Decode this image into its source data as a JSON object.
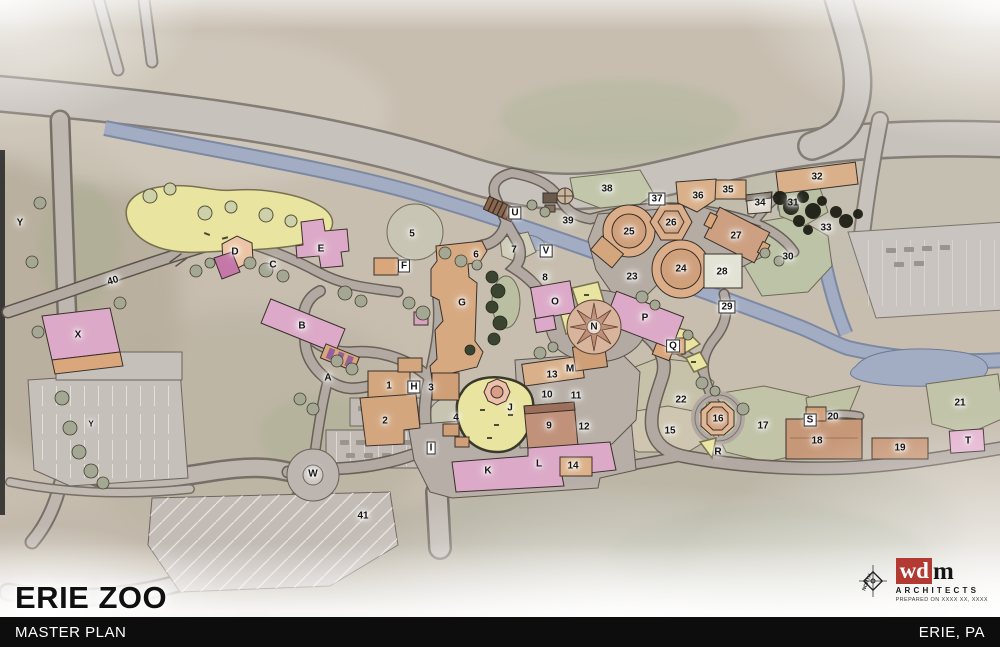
{
  "title": {
    "zoo": "ERIE ZOO"
  },
  "footer": {
    "project": "MASTER PLAN",
    "location": "ERIE, PA"
  },
  "logo": {
    "compass_label": "NORTH",
    "brand_wd": "wd",
    "brand_m": "m",
    "firm": "ARCHITECTS",
    "prepared_note": "PREPARED ON XXXX XX, XXXX"
  },
  "palette": {
    "footer_bg": "#0d0d0d",
    "footer_text": "#ffffff",
    "title_text": "#101010",
    "logo_red": "#b23a32",
    "map_base": "#c7beb0",
    "river_blue": "#a2adc4",
    "lawn_yellow": "#e9e4a0",
    "building_pink": "#dcaac8",
    "building_tan": "#d9ad85",
    "exhibit_green": "#bcc1a4",
    "road_gray": "#c6c0ba"
  },
  "map": {
    "markers": [
      {
        "id": "A",
        "x": 328,
        "y": 378
      },
      {
        "id": "B",
        "x": 302,
        "y": 326
      },
      {
        "id": "C",
        "x": 273,
        "y": 265
      },
      {
        "id": "D",
        "x": 235,
        "y": 252
      },
      {
        "id": "E",
        "x": 321,
        "y": 249
      },
      {
        "id": "F",
        "x": 404,
        "y": 266,
        "style": "box"
      },
      {
        "id": "G",
        "x": 462,
        "y": 303
      },
      {
        "id": "H",
        "x": 414,
        "y": 387,
        "style": "box"
      },
      {
        "id": "I",
        "x": 431,
        "y": 448,
        "style": "box"
      },
      {
        "id": "J",
        "x": 510,
        "y": 408
      },
      {
        "id": "K",
        "x": 488,
        "y": 471
      },
      {
        "id": "L",
        "x": 539,
        "y": 464
      },
      {
        "id": "M",
        "x": 570,
        "y": 369
      },
      {
        "id": "N",
        "x": 594,
        "y": 327
      },
      {
        "id": "O",
        "x": 555,
        "y": 302
      },
      {
        "id": "P",
        "x": 645,
        "y": 318
      },
      {
        "id": "Q",
        "x": 673,
        "y": 346,
        "style": "box"
      },
      {
        "id": "R",
        "x": 718,
        "y": 452
      },
      {
        "id": "S",
        "x": 810,
        "y": 420,
        "style": "box"
      },
      {
        "id": "T",
        "x": 968,
        "y": 441
      },
      {
        "id": "U",
        "x": 515,
        "y": 213,
        "style": "box"
      },
      {
        "id": "V",
        "x": 546,
        "y": 251,
        "style": "box"
      },
      {
        "id": "W",
        "x": 313,
        "y": 474
      },
      {
        "id": "X",
        "x": 78,
        "y": 335
      },
      {
        "id": "Y",
        "x": 20,
        "y": 223
      },
      {
        "id": "Y2",
        "label": "Y",
        "x": 91,
        "y": 424,
        "style": "small"
      },
      {
        "id": "1",
        "x": 389,
        "y": 386
      },
      {
        "id": "2",
        "x": 385,
        "y": 421
      },
      {
        "id": "3",
        "x": 431,
        "y": 388
      },
      {
        "id": "4",
        "x": 456,
        "y": 418
      },
      {
        "id": "5",
        "x": 412,
        "y": 234
      },
      {
        "id": "6",
        "x": 476,
        "y": 255
      },
      {
        "id": "7",
        "x": 514,
        "y": 250
      },
      {
        "id": "8",
        "x": 545,
        "y": 278
      },
      {
        "id": "9",
        "x": 549,
        "y": 426
      },
      {
        "id": "10",
        "x": 547,
        "y": 395
      },
      {
        "id": "11",
        "x": 576,
        "y": 396
      },
      {
        "id": "12",
        "x": 584,
        "y": 427
      },
      {
        "id": "13",
        "x": 552,
        "y": 375
      },
      {
        "id": "14",
        "x": 573,
        "y": 466
      },
      {
        "id": "15",
        "x": 670,
        "y": 431
      },
      {
        "id": "16",
        "x": 718,
        "y": 419
      },
      {
        "id": "17",
        "x": 763,
        "y": 426
      },
      {
        "id": "18",
        "x": 817,
        "y": 441
      },
      {
        "id": "19",
        "x": 900,
        "y": 448
      },
      {
        "id": "20",
        "x": 833,
        "y": 417
      },
      {
        "id": "21",
        "x": 960,
        "y": 403
      },
      {
        "id": "22",
        "x": 681,
        "y": 400
      },
      {
        "id": "23",
        "x": 632,
        "y": 277
      },
      {
        "id": "24",
        "x": 681,
        "y": 269
      },
      {
        "id": "25",
        "x": 629,
        "y": 232
      },
      {
        "id": "26",
        "x": 671,
        "y": 223
      },
      {
        "id": "27",
        "x": 736,
        "y": 236
      },
      {
        "id": "28",
        "x": 722,
        "y": 272
      },
      {
        "id": "29",
        "x": 727,
        "y": 307,
        "style": "box"
      },
      {
        "id": "30",
        "x": 788,
        "y": 257
      },
      {
        "id": "31",
        "x": 793,
        "y": 203
      },
      {
        "id": "32",
        "x": 817,
        "y": 177
      },
      {
        "id": "33",
        "x": 826,
        "y": 228
      },
      {
        "id": "34",
        "x": 760,
        "y": 203
      },
      {
        "id": "35",
        "x": 728,
        "y": 190
      },
      {
        "id": "36",
        "x": 698,
        "y": 196
      },
      {
        "id": "37",
        "x": 657,
        "y": 199,
        "style": "box"
      },
      {
        "id": "38",
        "x": 607,
        "y": 189
      },
      {
        "id": "39",
        "x": 568,
        "y": 221
      },
      {
        "id": "40",
        "x": 113,
        "y": 281,
        "rot": -17
      },
      {
        "id": "41",
        "x": 363,
        "y": 516
      }
    ]
  }
}
